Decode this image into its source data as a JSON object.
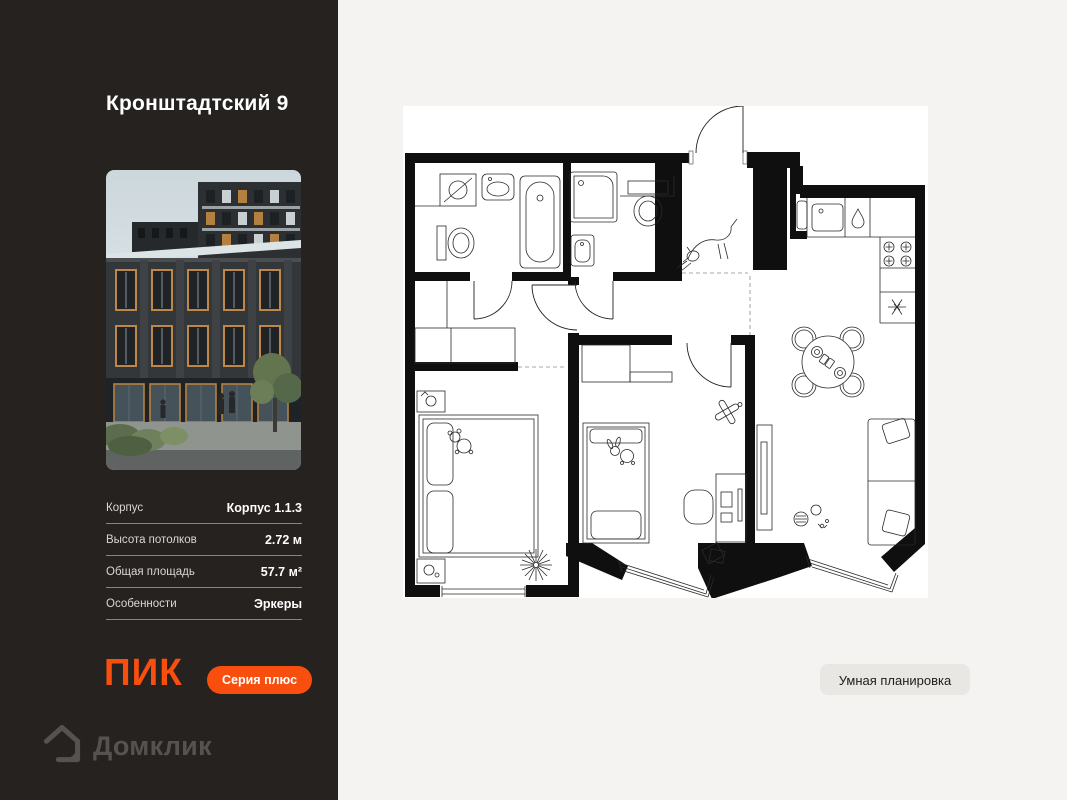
{
  "panel": {
    "title": "Кронштадтский 9",
    "details": [
      {
        "label": "Корпус",
        "value": "Корпус 1.1.3"
      },
      {
        "label": "Высота потолков",
        "value": "2.72 м"
      },
      {
        "label": "Общая площадь",
        "value": "57.7 м²"
      },
      {
        "label": "Особенности",
        "value": "Эркеры"
      }
    ],
    "pik_logo_text": "ПИК",
    "series_badge_label": "Серия плюс"
  },
  "footer": {
    "domclick_logo_text": "Домклик",
    "domclick_icon": "house-chat-icon"
  },
  "plan": {
    "smart_button_label": "Умная планировка",
    "floor_plan_icons": [
      "bathtub",
      "shower",
      "toilet",
      "washing-machine",
      "sink",
      "stove-burners",
      "fridge-snowflake",
      "dining-table",
      "sofa",
      "double-bed",
      "single-bed",
      "desk-chair",
      "dog-sketch",
      "plant-starburst",
      "toy-plane",
      "bay-windows"
    ]
  },
  "colors": {
    "accent_orange": "#F84E0E",
    "panel_background": "#262220",
    "page_background": "#F4F3F1",
    "smart_button_background": "#E8E7E3",
    "domclick_gray": "#56534F",
    "plan_background": "#FFFFFF"
  }
}
